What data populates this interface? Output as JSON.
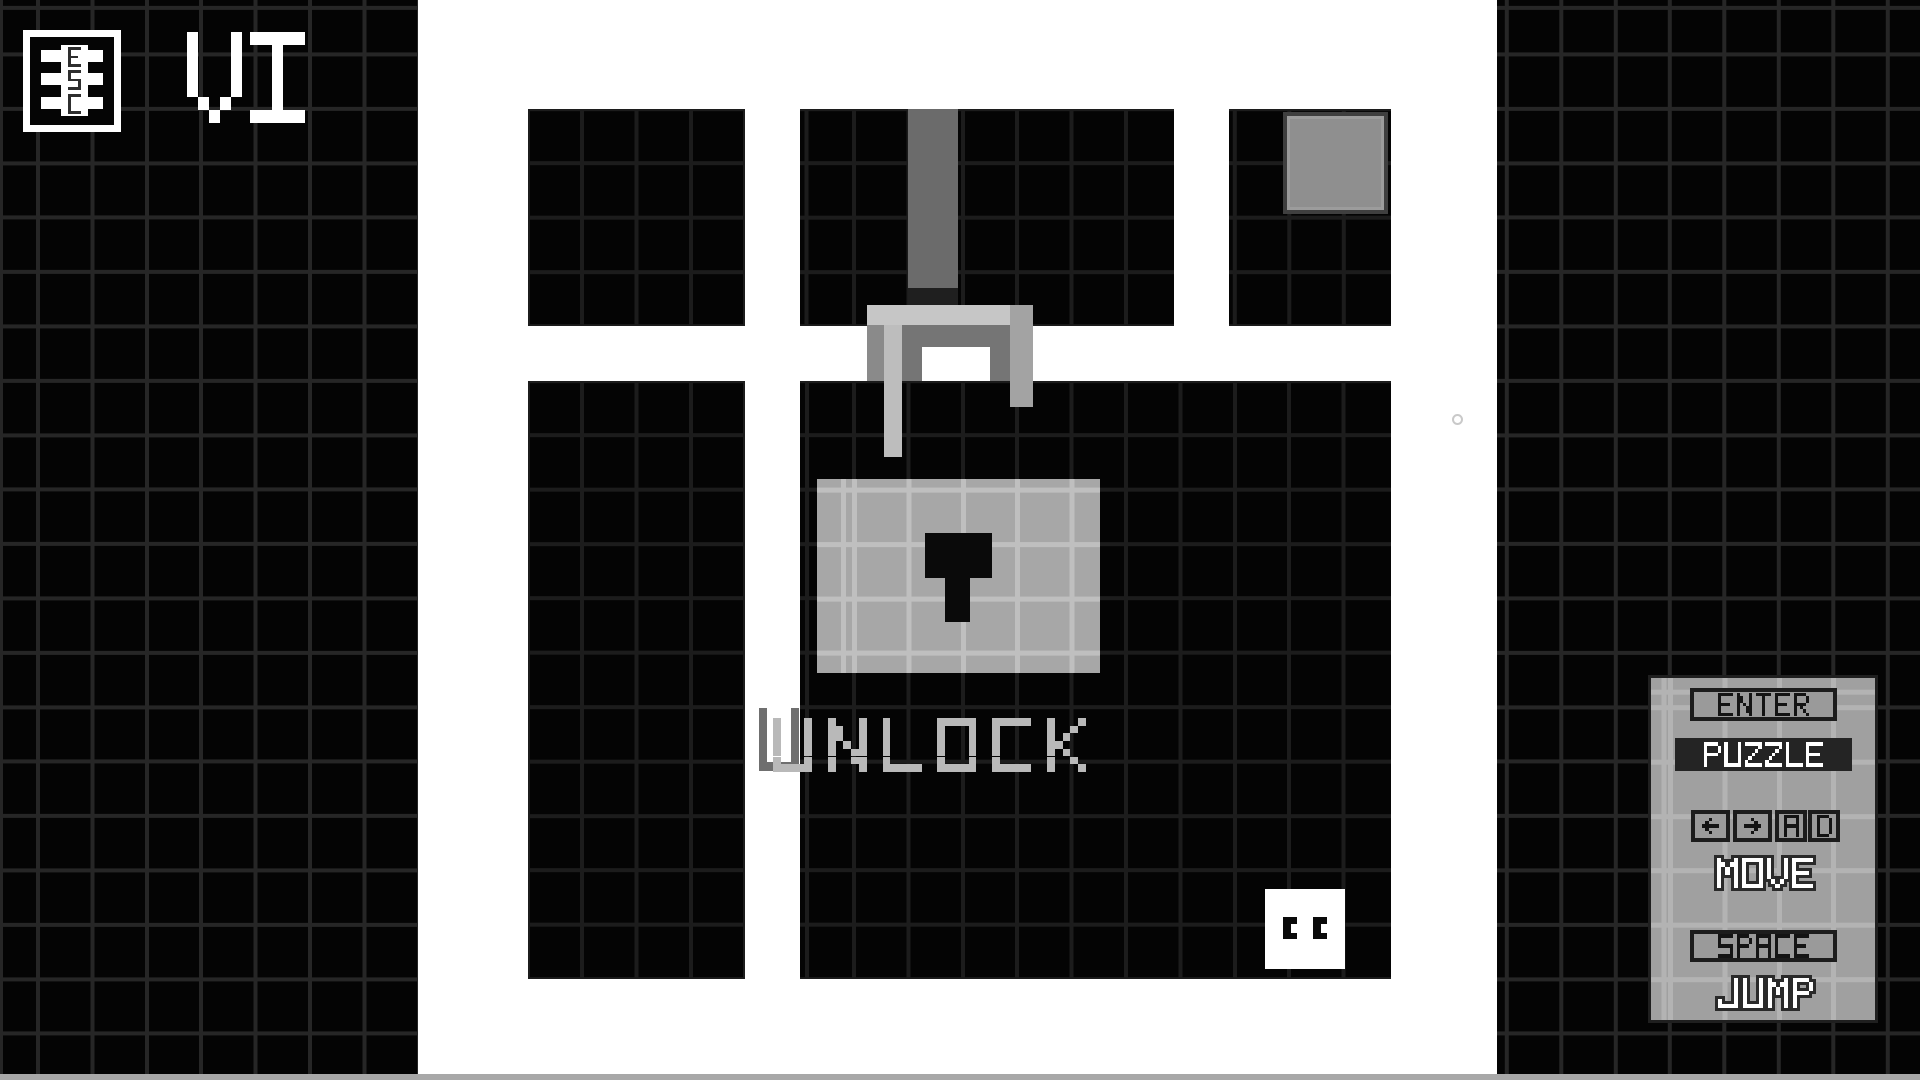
{
  "screen": {
    "background": "#ffffff"
  },
  "hud": {
    "esc_icon": {
      "letters": [
        "E",
        "S",
        "C"
      ]
    },
    "logo": "VI"
  },
  "level": {
    "unlock_label": "UNLOCK",
    "unlock_shadow_letter": "U"
  },
  "controls": {
    "enter_key": "ENTER",
    "enter_action": "PUZZLE",
    "left_key": "←",
    "right_key": "→",
    "key_a": "A",
    "key_d": "D",
    "move_action": "MOVE",
    "space_key": "SPACE",
    "jump_action": "JUMP"
  },
  "colors": {
    "block_black": "#040404",
    "grid_line_dark": "#1c1c1c",
    "chain_gray": "#6b6b6b",
    "shackle_light": "#c6c6c6",
    "shackle_mid": "#757575",
    "lock_body": "#a7a7a7",
    "unlock_text": "#b9b9b9",
    "panel_gray": "#a0a0a0",
    "keycap_border": "#1c1c1c",
    "puzzle_box": "#242424",
    "white": "#ffffff"
  }
}
